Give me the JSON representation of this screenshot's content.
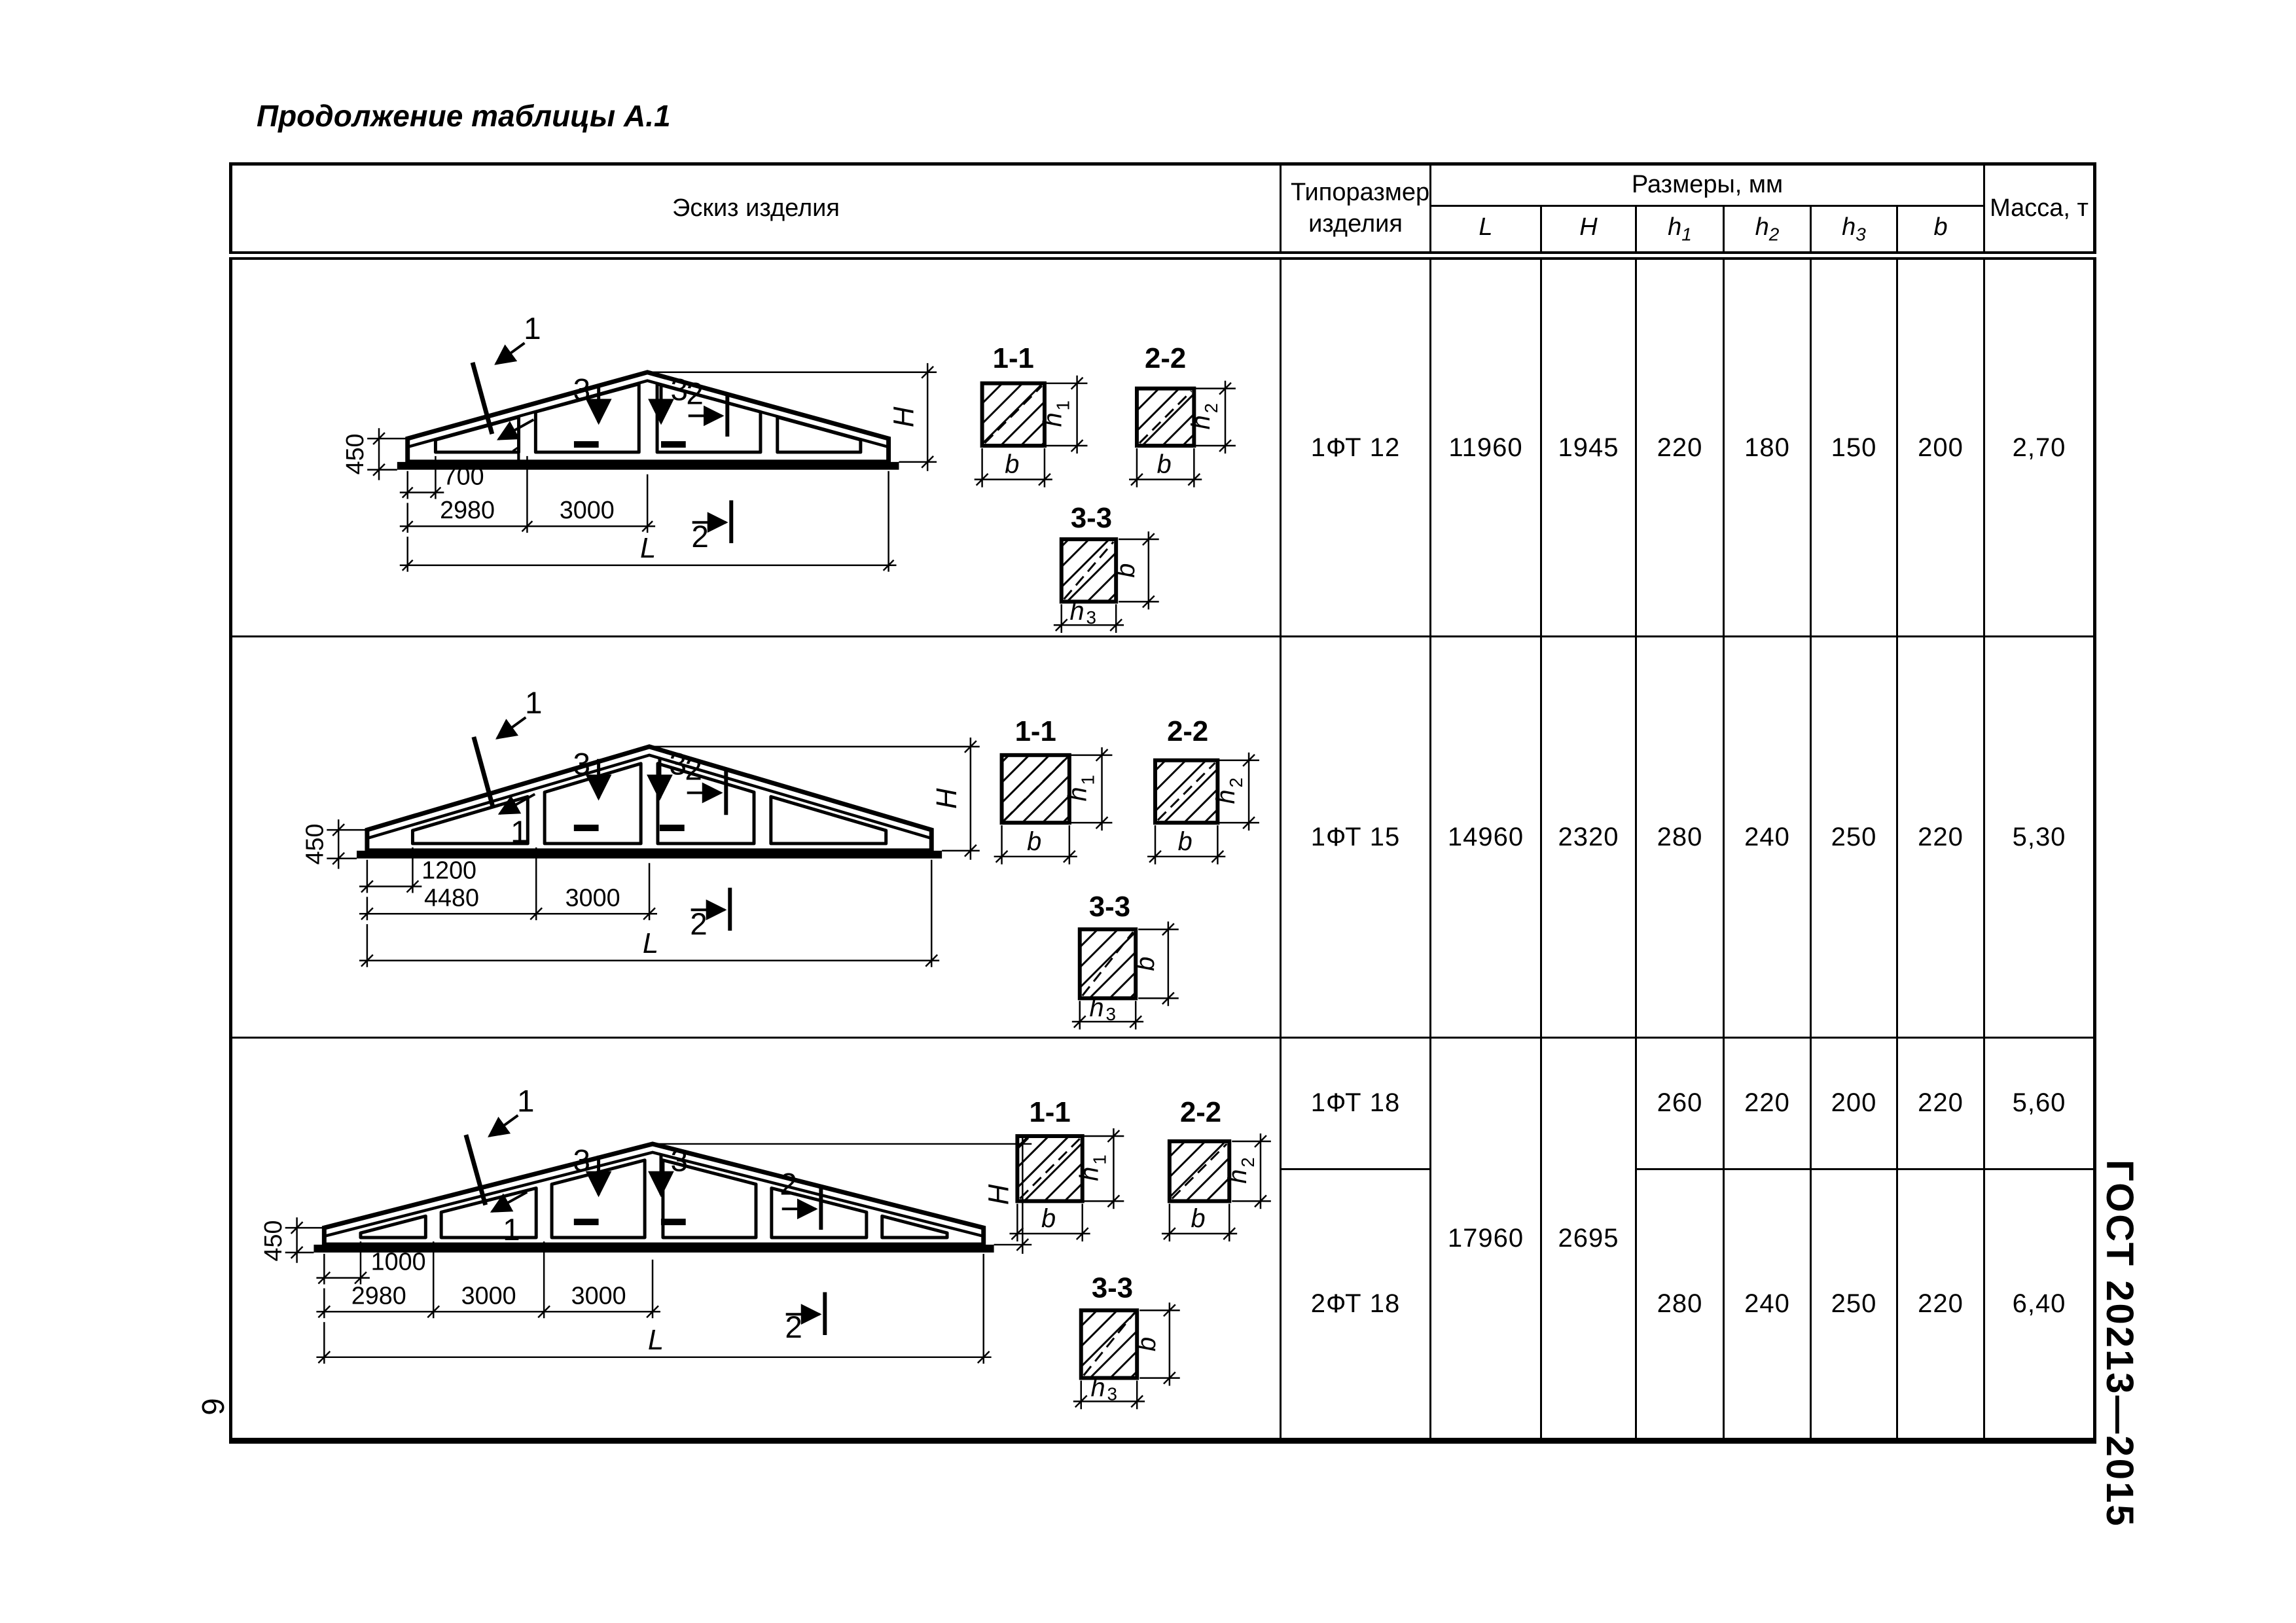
{
  "page": {
    "title": "Продолжение таблицы А.1",
    "gost": "ГОСТ 20213—2015",
    "number": "6"
  },
  "table": {
    "header": {
      "sketch": "Эскиз изделия",
      "type": "Типоразмер изделия",
      "dims": "Размеры, мм",
      "mass": "Масса, т"
    },
    "cols": [
      {
        "main": "L",
        "sub": ""
      },
      {
        "main": "H",
        "sub": ""
      },
      {
        "main": "h",
        "sub": "1"
      },
      {
        "main": "h",
        "sub": "2"
      },
      {
        "main": "h",
        "sub": "3"
      },
      {
        "main": "b",
        "sub": ""
      }
    ],
    "rows": [
      {
        "type": "1ФТ 12",
        "L": "11960",
        "H": "1945",
        "h1": "220",
        "h2": "180",
        "h3": "150",
        "b": "200",
        "mass": "2,70"
      },
      {
        "type": "1ФТ 15",
        "L": "14960",
        "H": "2320",
        "h1": "280",
        "h2": "240",
        "h3": "250",
        "b": "220",
        "mass": "5,30"
      },
      {
        "type": "1ФТ 18",
        "L": "17960",
        "H": "2695",
        "h1": "260",
        "h2": "220",
        "h3": "200",
        "b": "220",
        "mass": "5,60"
      },
      {
        "type": "2ФТ 18",
        "h1": "280",
        "h2": "240",
        "h3": "250",
        "b": "220",
        "mass": "6,40"
      }
    ]
  },
  "sk": {
    "left_height": "450",
    "L": "L",
    "H": "H",
    "c1": "1",
    "c2": "2",
    "c3": "3",
    "s11": "1-1",
    "s22": "2-2",
    "s33": "3-3",
    "h": "h",
    "b": "b",
    "u1": "1",
    "u2": "2",
    "u3": "3"
  },
  "r1": {
    "segs": [
      "700",
      "2980",
      "3000"
    ]
  },
  "r2": {
    "segs": [
      "1200",
      "4480",
      "3000"
    ]
  },
  "r3": {
    "segs": [
      "1000",
      "2980",
      "3000",
      "3000"
    ]
  }
}
